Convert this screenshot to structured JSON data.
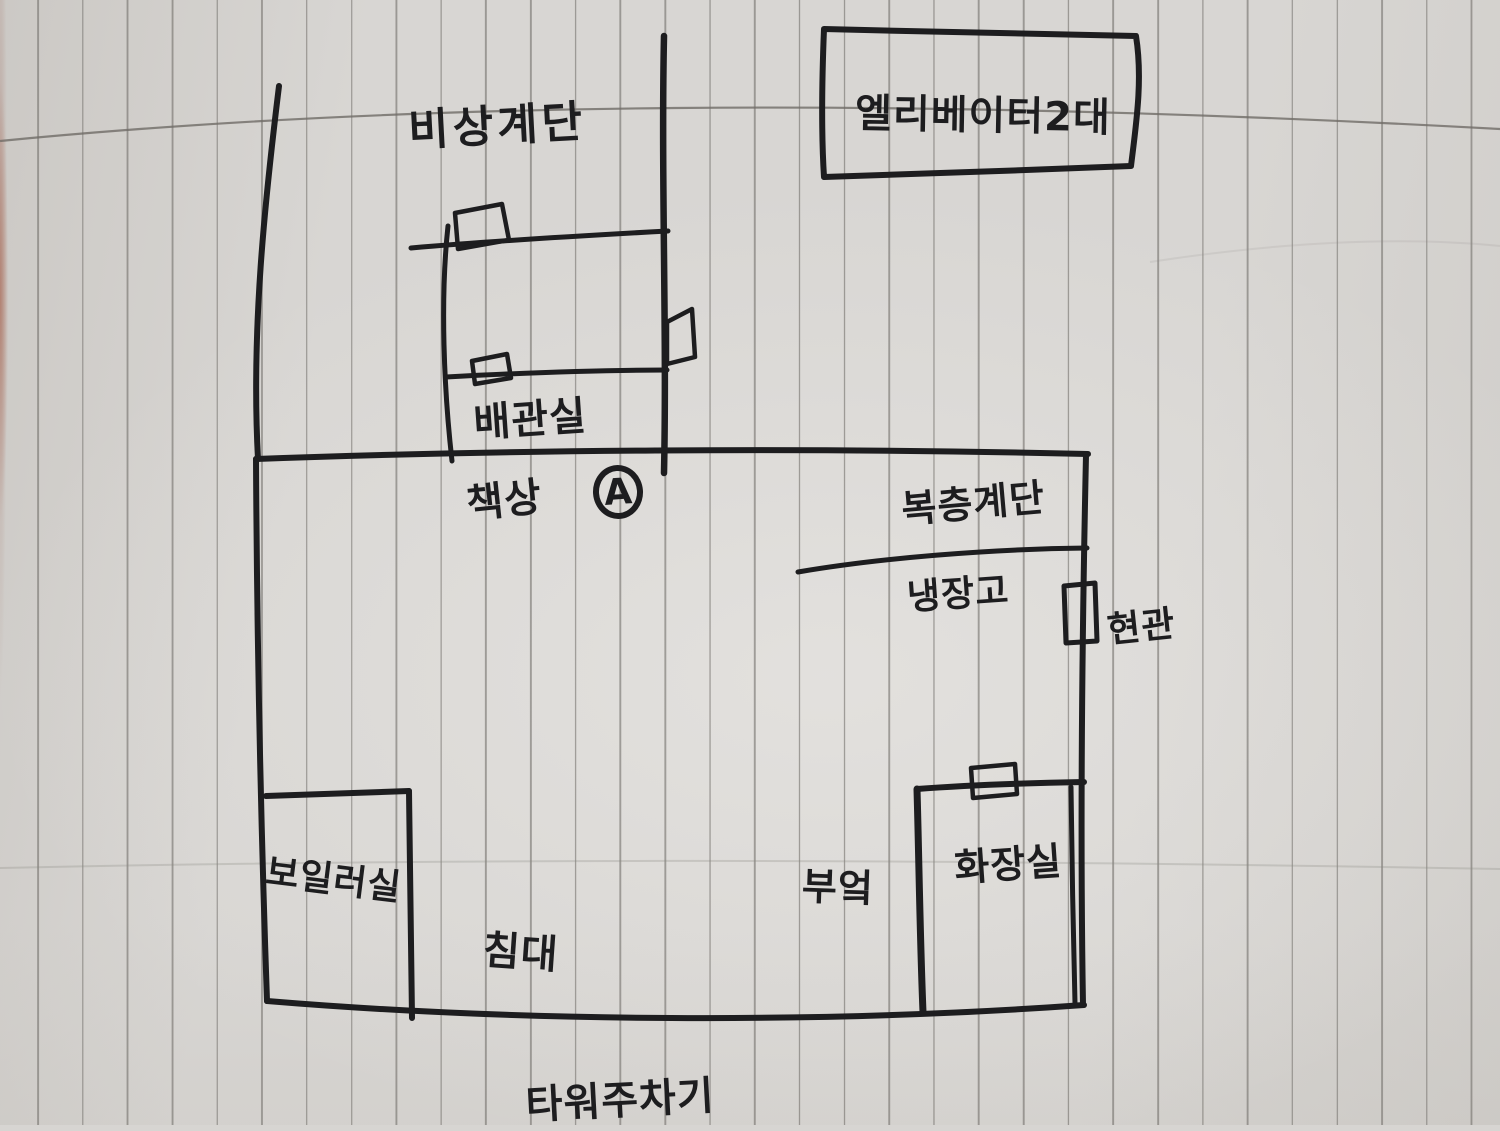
{
  "document": {
    "kind_note": "hand-drawn floor plan sketch on vertically ruled notebook paper",
    "ink_color": "#1d1d1f",
    "paper_color": "#d7d5d2",
    "rule_color": "#68655f"
  },
  "labels": {
    "emergency_stairs": "비상계단",
    "elevators": "엘리베이터2대",
    "pipe_room": "배관실",
    "desk": "책상",
    "marker_a": "A",
    "loft_stairs": "복층계단",
    "refrigerator": "냉장고",
    "entrance": "현관",
    "boiler_room": "보일러실",
    "kitchen": "부엌",
    "bathroom": "화장실",
    "bed": "침대",
    "tower_parking": "타워주차기"
  }
}
